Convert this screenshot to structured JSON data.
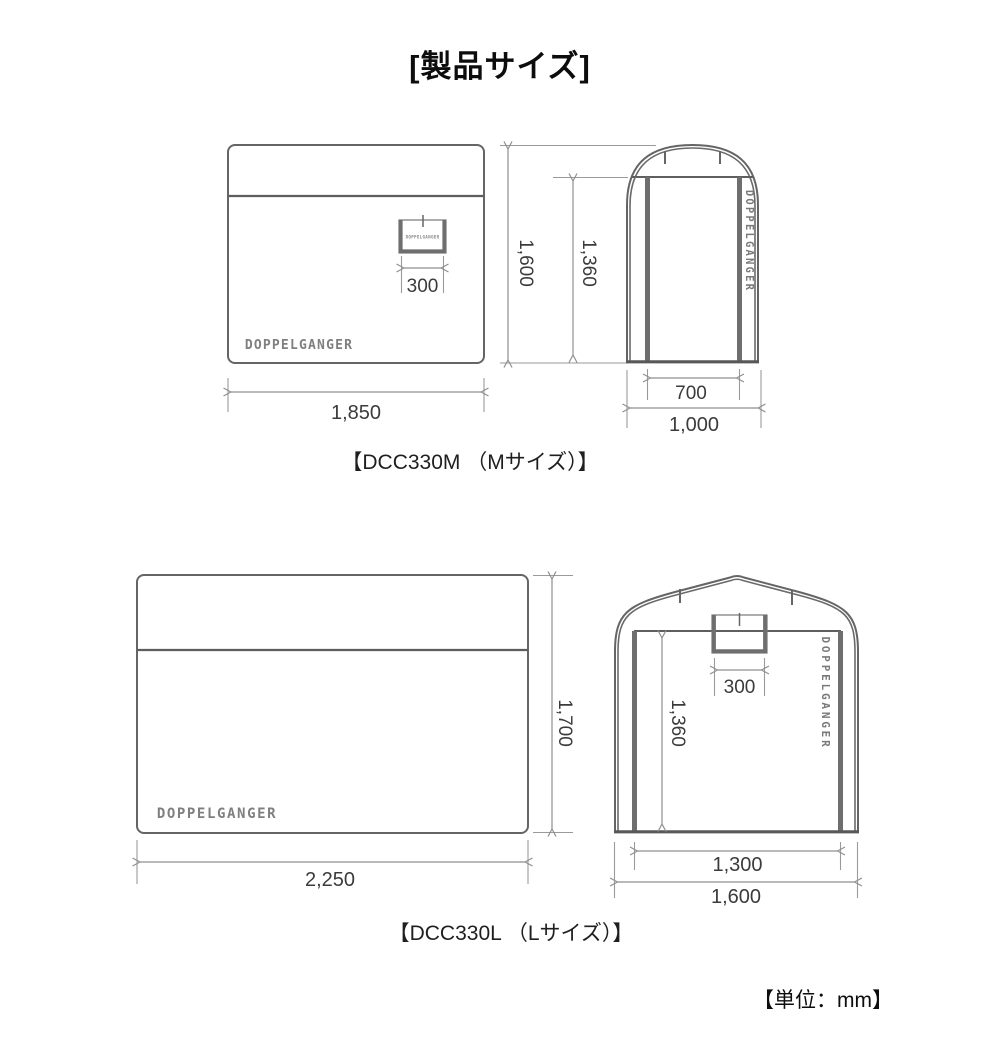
{
  "title": "[製品サイズ]",
  "unit_note": "【単位：mm】",
  "brand": "DOPPELGANGER",
  "colors": {
    "outline_gray": "#656565",
    "dimension_gray": "#8f8f8f",
    "dimension_text": "#3b3b3b",
    "logo_gray": "#7f7f7f",
    "heading_black": "#0d0d0d"
  },
  "m": {
    "caption": "【DCC330M （Mサイズ）】",
    "side_width": "1,850",
    "window_width": "300",
    "height": "1,600",
    "inner_height": "1,360",
    "door_width": "700",
    "front_width": "1,000"
  },
  "l": {
    "caption": "【DCC330L （Lサイズ）】",
    "side_width": "2,250",
    "height": "1,700",
    "window_width": "300",
    "inner_height": "1,360",
    "door_width": "1,300",
    "front_width": "1,600"
  }
}
